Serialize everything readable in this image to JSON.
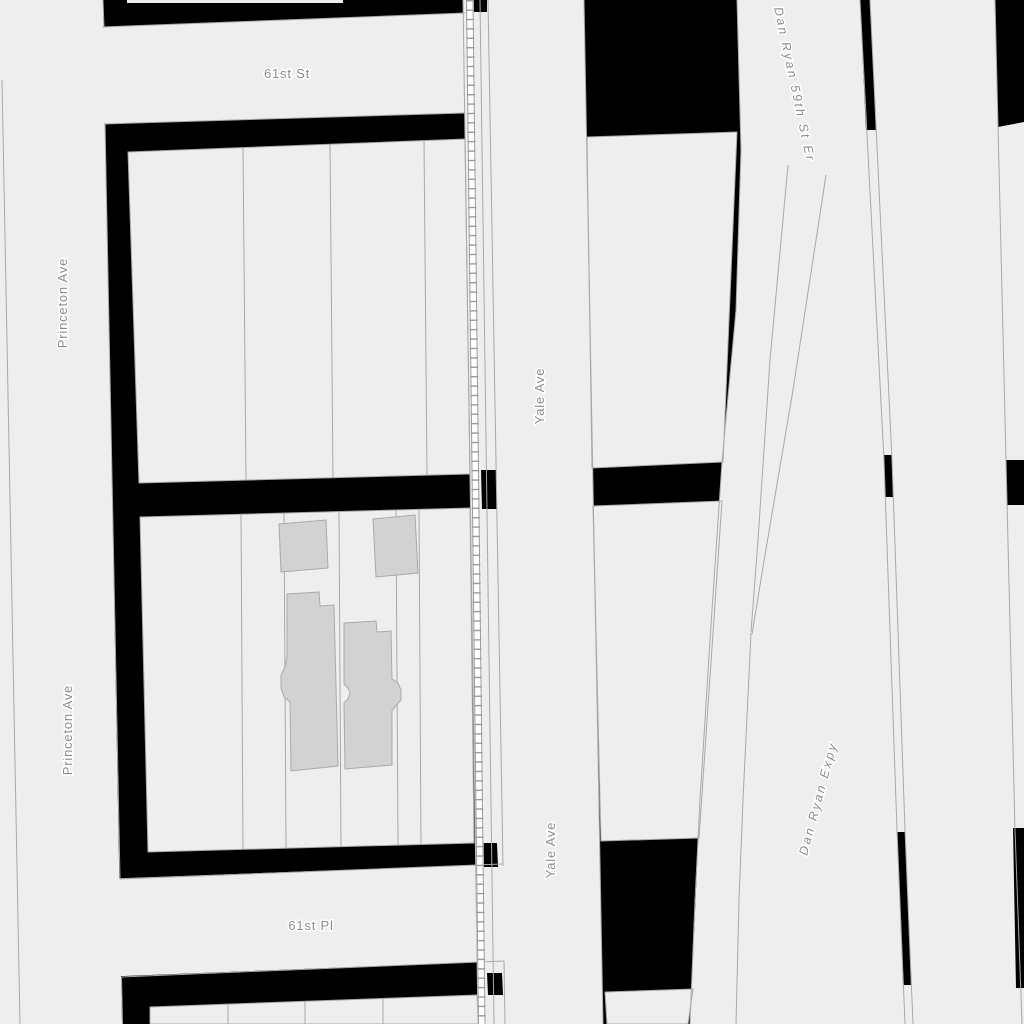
{
  "map": {
    "labels": {
      "street_61st_st": "61st St",
      "street_61st_pl": "61st Pl",
      "princeton_ave_north": "Princeton Ave",
      "princeton_ave_south": "Princeton Ave",
      "yale_ave_north": "Yale Ave",
      "yale_ave_south": "Yale Ave",
      "dan_ryan_ramp": "Dan Ryan 59th St Er",
      "dan_ryan_expy": "Dan Ryan Expy"
    },
    "colors": {
      "background": "#000000",
      "land": "#eeeeee",
      "building_fill": "#d2d2d2",
      "building_stroke": "#a9a9a9",
      "parcel_line": "#a8a8a8",
      "railroad": "#9a9a9a",
      "label_text": "#8c8c8c",
      "label_halo": "#ffffff"
    }
  }
}
